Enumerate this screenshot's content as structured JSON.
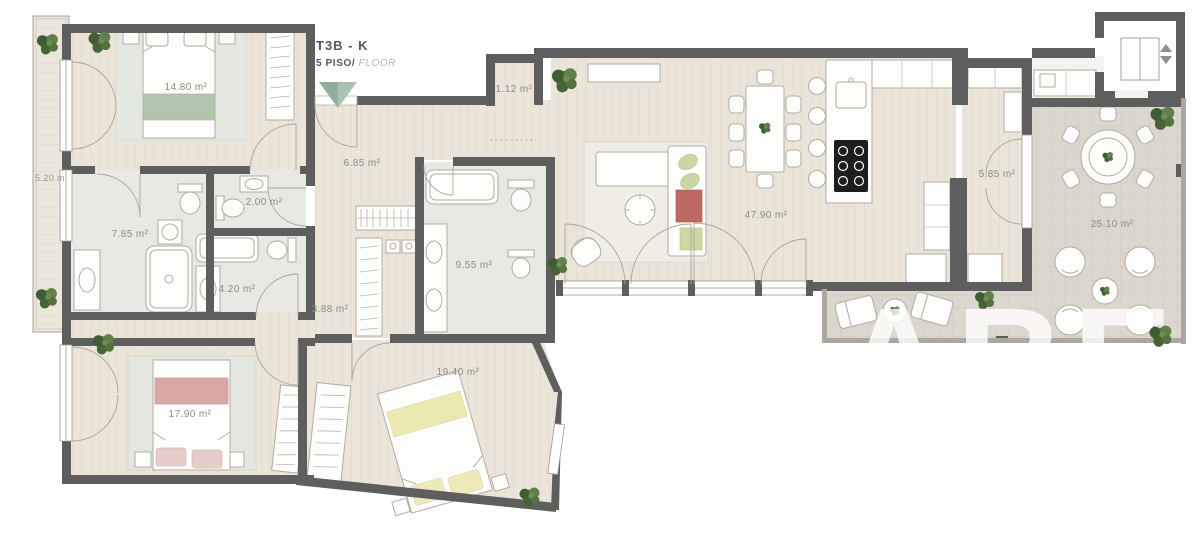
{
  "title": {
    "unit": "T3B - K",
    "floor": "5 PISO/",
    "floor_suffix": " FLOOR"
  },
  "watermark": "ABE",
  "colors": {
    "wall": "#5e5e5e",
    "wood_floor": "#eae4d9",
    "bath_floor": "#e9e8e5",
    "terrace_floor": "#dcd7ce",
    "accent_green_marker": "#a9c2b1",
    "bed_green": "#b3c6ad",
    "bed_pink": "#d9a8a4",
    "bed_yellow": "#ece9b0",
    "sofa_red": "#bd6a64",
    "plant_green": "#54713f",
    "label_gray": "#8b8b86"
  },
  "rooms": [
    {
      "id": "bedroom-1",
      "area": "14.80 m²"
    },
    {
      "id": "hall",
      "area": "6.85 m²"
    },
    {
      "id": "wc",
      "area": "2.00 m²"
    },
    {
      "id": "bathroom-1",
      "area": "7.85 m²"
    },
    {
      "id": "bathroom-2",
      "area": "4.20 m²"
    },
    {
      "id": "closet-corridor",
      "area": "3.88 m²"
    },
    {
      "id": "bathroom-3",
      "area": "9.55 m²"
    },
    {
      "id": "storage-niche",
      "area": "1.12 m²"
    },
    {
      "id": "living-kitchen",
      "area": "47.90 m²"
    },
    {
      "id": "pantry-hall",
      "area": "5.85 m²"
    },
    {
      "id": "terrace",
      "area": "25.10 m²"
    },
    {
      "id": "bedroom-2",
      "area": "17.90 m²"
    },
    {
      "id": "bedroom-3",
      "area": "19.40 m²"
    },
    {
      "id": "balcony",
      "area": "5.20 m"
    }
  ]
}
